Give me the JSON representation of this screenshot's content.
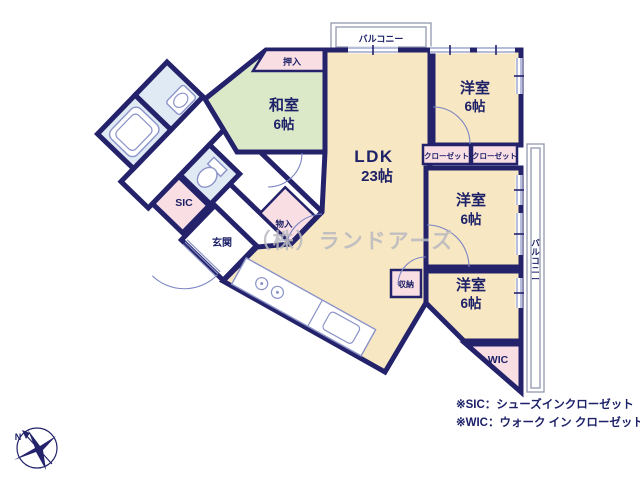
{
  "colors": {
    "wall": "#23226b",
    "beige": "#f7e7c3",
    "green": "#dce9c9",
    "pink": "#f9dfe4",
    "blue": "#dfeaf5",
    "white": "#ffffff",
    "thinline": "#8b93c8",
    "text": "#1d2168",
    "watermark": "#b9b9c0"
  },
  "plan": {
    "compass": {
      "n": "N"
    },
    "balcony_top": "バルコニー",
    "balcony_right": "バルコニー",
    "rooms": {
      "washitsu": {
        "name": "和室",
        "size": "6帖"
      },
      "ldk": {
        "name": "LDK",
        "size": "23帖"
      },
      "bedroom_top": {
        "name": "洋室",
        "size": "6帖"
      },
      "bedroom_mid": {
        "name": "洋室",
        "size": "6帖"
      },
      "bedroom_btm": {
        "name": "洋室",
        "size": "6帖"
      },
      "entrance": "玄関"
    },
    "storage": {
      "oshiire": "押入",
      "closet_a": "クローゼット",
      "closet_b": "クローゼット",
      "monoire": "物入",
      "shuno": "収納",
      "sic": "SIC",
      "wic": "WIC"
    },
    "notes": {
      "sic": "※SIC：シューズインクローゼット",
      "wic": "※WIC：ウォーク イン クローゼット"
    },
    "watermark": "（株）ランドアーズ"
  }
}
